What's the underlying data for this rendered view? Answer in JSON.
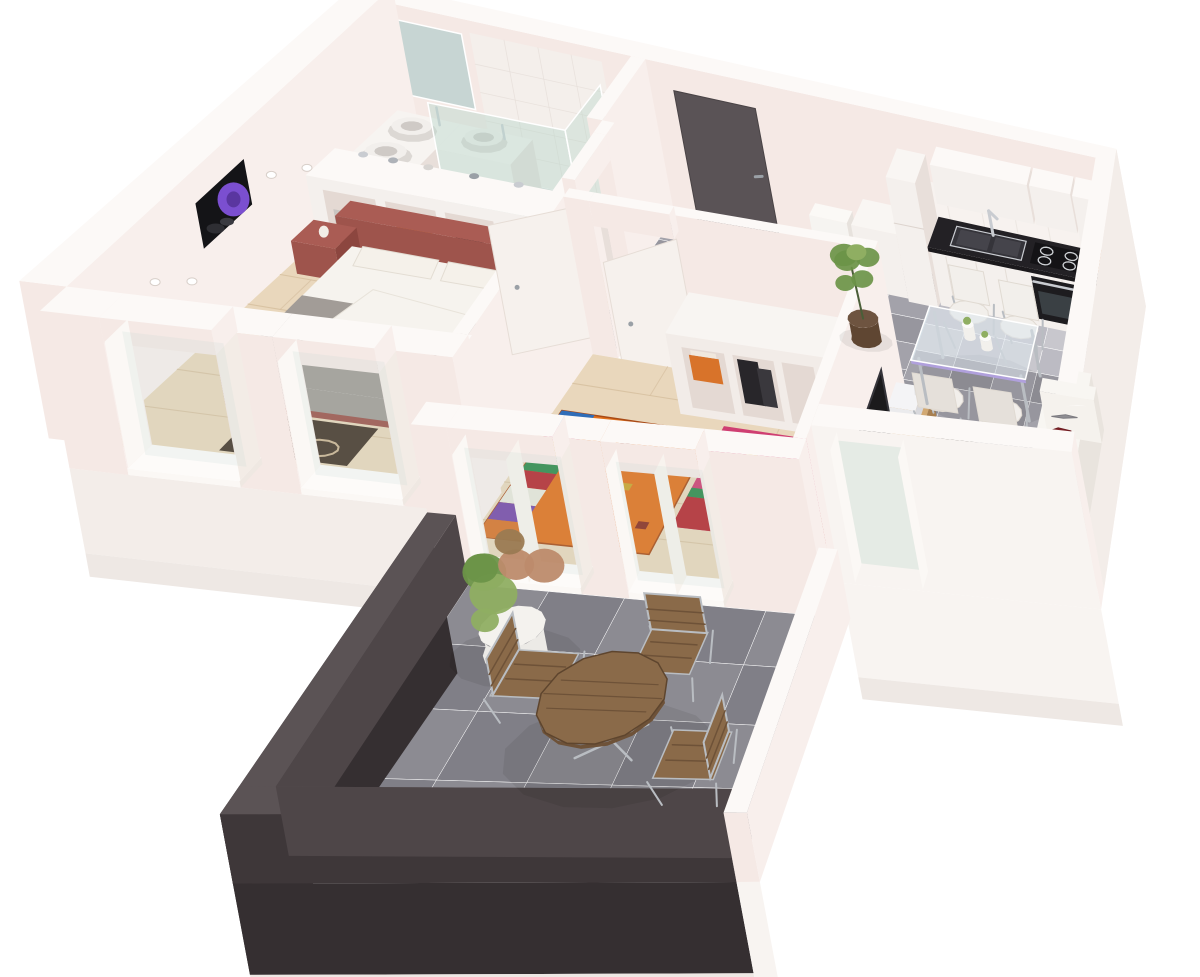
{
  "meta": {
    "description": "3D isometric render of a two-bedroom apartment floor plan with balcony",
    "canvas": {
      "width": 1200,
      "height": 977
    }
  },
  "palette": {
    "bg": "#ffffff",
    "wallTop": "#fcf9f7",
    "wallFaceS": "#f5e9e5",
    "wallFaceE": "#f8efec",
    "facade": "#f3ede9",
    "facadeBright": "#f8f4f1",
    "slabTrim": "#eee8e4",
    "woodFloor": "#e9d7bc",
    "woodLine": "#d6bf9f",
    "tileA": "#a3a2aa",
    "tileB": "#97969e",
    "tileLightA": "#c8c7cd",
    "tileLightB": "#bcbbc3",
    "balcTileA": "#8c8b92",
    "balcTileB": "#807f87",
    "bathTileA": "#dedadb",
    "bathTileB": "#d3cfd1",
    "parapetTop": "#5b5355",
    "parapetIn": "#4e4648",
    "parapetOut": "#3e3739",
    "facadeDark": "#352f31",
    "doorDark": "#5a5356",
    "doorWhite": "#f6f1ed",
    "handle": "#9aa0a6",
    "bedFrame": "#9e544c",
    "pillowWhite": "#f5f1ea",
    "blanketGray": "#a29c97",
    "duvet": "#f6f3ee",
    "rugDark": "#46362a",
    "rugDarkPattern": "#cbb392",
    "rugOrange": "#e2711c",
    "rugOrangeBorder": "#a84a16",
    "rugPink": "#cf3f72",
    "rugRed": "#b5282f",
    "rugYellow": "#e2c25a",
    "rugStripes": [
      "#2f6db8",
      "#c23a66",
      "#caa22a",
      "#2e8a4a",
      "#b5282f",
      "#e8e6da",
      "#7648a8",
      "#d8732a"
    ],
    "wardrobe": "#f2ece8",
    "cubbyShadow": "#e4d9d3",
    "boxOrange": "#d8732a",
    "bagBlack": "#28262a",
    "blanketCream": "#e8ddba",
    "towelGray": "#b2aeab",
    "cabinet": "#f4f0ed",
    "cabinetShade": "#e8dfda",
    "counterDark": "#232125",
    "counterEdge": "#1b191c",
    "steel": "#c9ccd1",
    "cooktop": "#141316",
    "ovenFace": "#1d1c1f",
    "ovenGlass": "#3a4044",
    "plateOrange": "#cf7030",
    "glassTop": "#dde6ec",
    "glassEdge": "#cdd8de",
    "tableAccent": "#b0a0dc",
    "chairWhite": "#f2efeb",
    "chairShade": "#e5e0da",
    "chrome": "#b9bdc2",
    "sofa": "#f5f2ed",
    "sofaShade": "#e9e4de",
    "pillowGray": "#8f8e93",
    "pillowRed": "#7e2126",
    "lrRugBase": "#2e2620",
    "lrRugTan": "#c7a77e",
    "lrRugBrown": "#53402f",
    "lrRugCream": "#e8d9b8",
    "tvBlack": "#1b1a1c",
    "console": "#c49a66",
    "consoleShade": "#a87f4f",
    "device": "#ebebed",
    "plantGreen": "#6b9448",
    "plantGreen2": "#8fae62",
    "plantSalmon": "#bd8b6b",
    "potBrown": "#5f4632",
    "potWhite": "#eceae6",
    "drumBrown": "#8a5f3c",
    "drumTop": "#c9a97c",
    "artBlack": "#141417",
    "artPurple": "#7b4fd0",
    "mirror": "#c2d3d0",
    "showerGlass": "#b8d6cb",
    "toiletWhite": "#f6f4f1",
    "shadow": "#000000"
  },
  "scene": {
    "rooms": [
      {
        "name": "bathroom",
        "floor": "light-tile",
        "items": [
          "vanity-counter",
          "twin-basins",
          "mirror",
          "shower-glass-screen"
        ]
      },
      {
        "name": "bedroom-1",
        "floor": "wood",
        "items": [
          "double-bed",
          "headboard-shelf",
          "purple-flower-artwork",
          "dark-pattern-rug",
          "black-folding-chair",
          "storage-cubbies",
          "two-windows"
        ]
      },
      {
        "name": "hallway",
        "floor": "gray-tile",
        "items": [
          "entry-door",
          "toilet",
          "djembe-drum",
          "potted-plant",
          "fridge",
          "cabinet"
        ]
      },
      {
        "name": "bedroom-2",
        "floor": "wood",
        "items": [
          "open-wardrobe",
          "orange-rug",
          "pink-red-rug",
          "two-windows",
          "door"
        ]
      },
      {
        "name": "kitchen",
        "floor": "light-gray-tile",
        "items": [
          "dark-countertop",
          "double-sink",
          "cooktop",
          "oven",
          "upper-cabinets",
          "orange-plate-stack"
        ]
      },
      {
        "name": "dining-area",
        "floor": "gray-tile",
        "items": [
          "glass-table",
          "white-chairs",
          "vases"
        ]
      },
      {
        "name": "living-room",
        "floor": "gray-tile",
        "items": [
          "white-sofa",
          "gray-red-pillows",
          "patterned-rug",
          "white-coffee-table",
          "green-plate",
          "tv-panel",
          "wood-tv-console",
          "white-device"
        ]
      },
      {
        "name": "balcony",
        "floor": "dark-gray-tile",
        "items": [
          "dark-parapet",
          "bistro-table",
          "metal-wood-chairs",
          "potted-shrub"
        ]
      }
    ],
    "counts": {
      "dining_chairs": 4,
      "balcony_chairs": 3,
      "bedroom1_windows": 2,
      "bedroom2_windows": 2,
      "basins": 3,
      "sofa_pillows": 4
    }
  }
}
